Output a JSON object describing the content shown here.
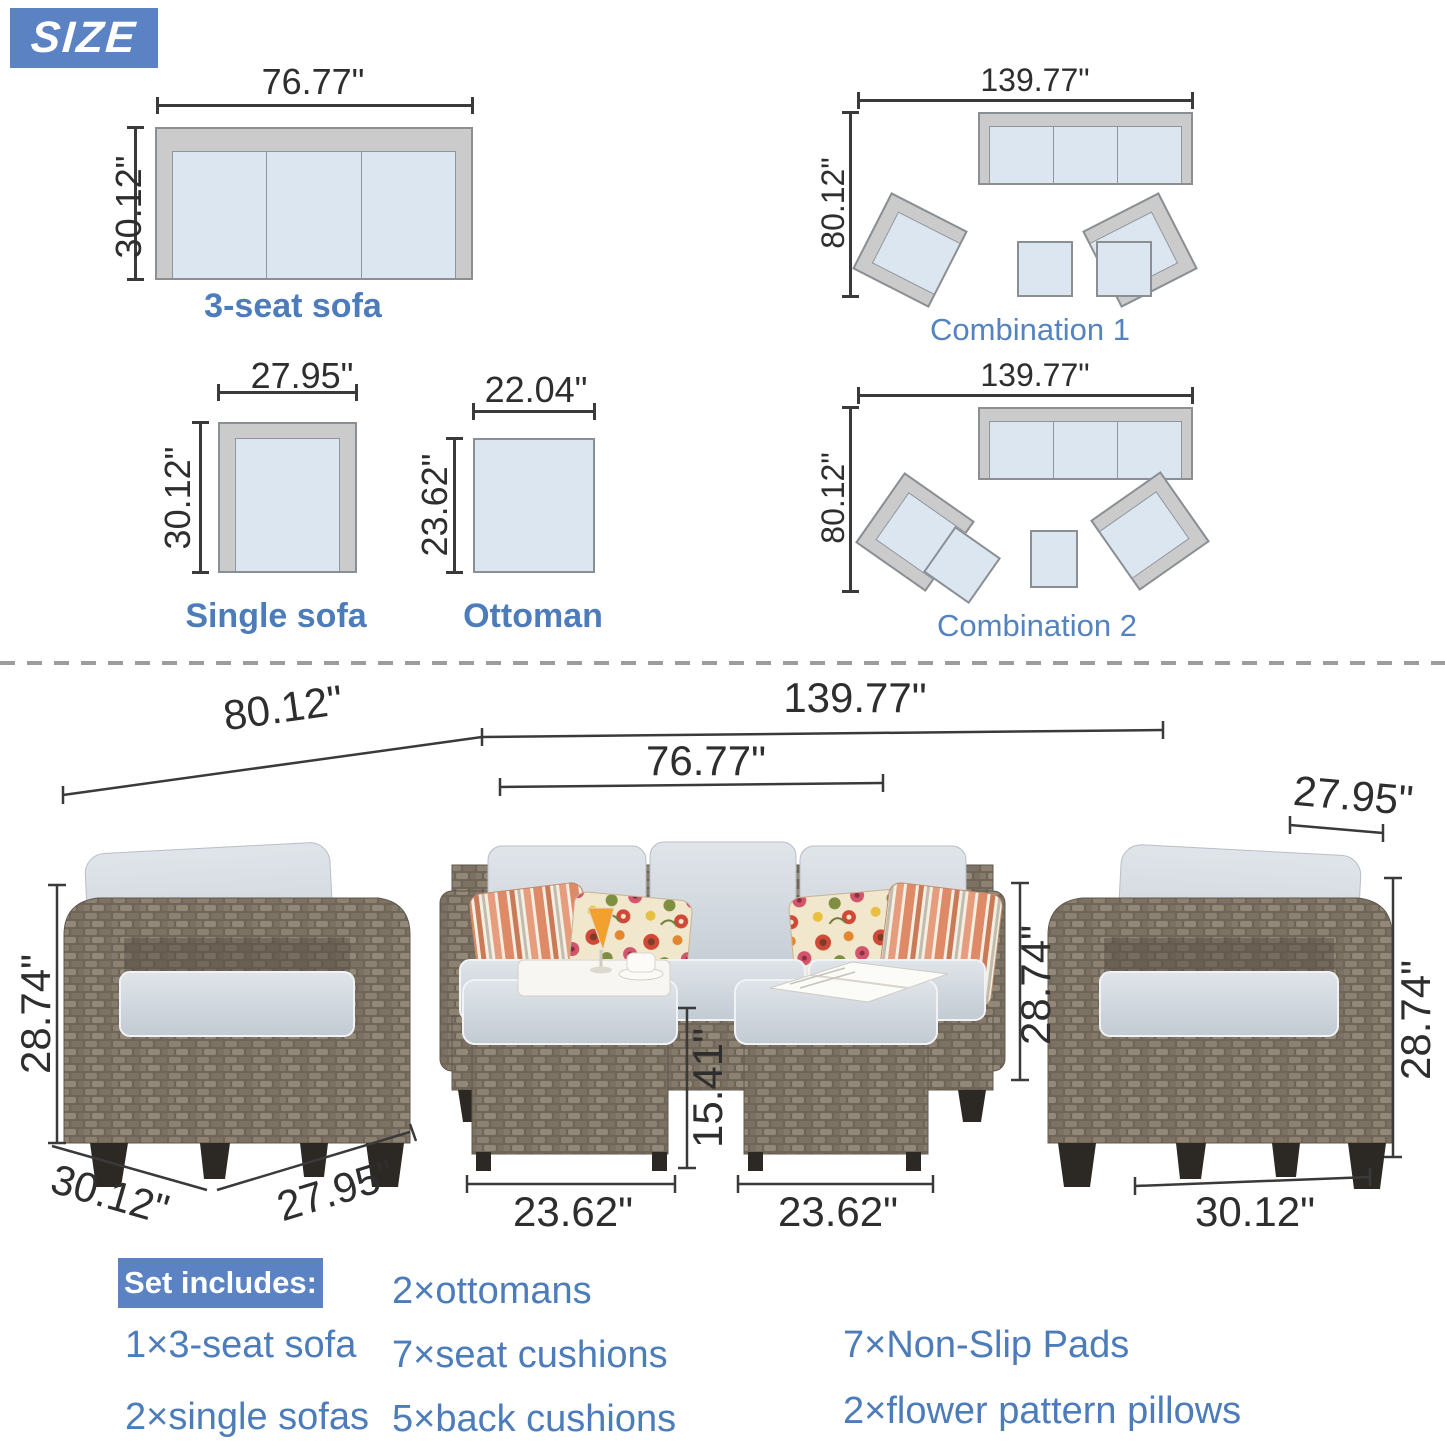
{
  "badge_label": "SIZE",
  "colors": {
    "accent_blue": "#5b82c3",
    "label_blue": "#4d7cba",
    "dim_text": "#2e2e2e",
    "diagram_seat_fill": "#dce6f1",
    "diagram_frame_fill": "#cbcbcb"
  },
  "top_diagrams": {
    "three_seat_sofa": {
      "label": "3-seat sofa",
      "width": "76.77\"",
      "depth": "30.12\""
    },
    "single_sofa": {
      "label": "Single sofa",
      "width": "27.95\"",
      "depth": "30.12\""
    },
    "ottoman": {
      "label": "Ottoman",
      "width": "22.04\"",
      "depth": "23.62\""
    },
    "combination_1": {
      "label": "Combination 1",
      "width": "139.77\"",
      "depth": "80.12\""
    },
    "combination_2": {
      "label": "Combination 2",
      "width": "139.77\"",
      "depth": "80.12\""
    }
  },
  "photo_dimensions": {
    "set_width": "139.77\"",
    "set_depth": "80.12\"",
    "sofa_width": "76.77\"",
    "sofa_height": "28.74\"",
    "left_chair_height": "28.74\"",
    "left_chair_depth": "30.12\"",
    "left_chair_width": "27.95\"",
    "right_chair_width": "27.95\"",
    "right_chair_height": "28.74\"",
    "right_chair_depth": "30.12\"",
    "left_ottoman_width": "23.62\"",
    "right_ottoman_width": "23.62\"",
    "ottoman_height": "15.41\""
  },
  "set_includes": {
    "header": "Set includes:",
    "items": [
      "1×3-seat sofa",
      "2×single sofas",
      "2×ottomans",
      "7×seat cushions",
      "5×back cushions",
      "7×Non-Slip Pads",
      "2×flower pattern pillows"
    ]
  }
}
